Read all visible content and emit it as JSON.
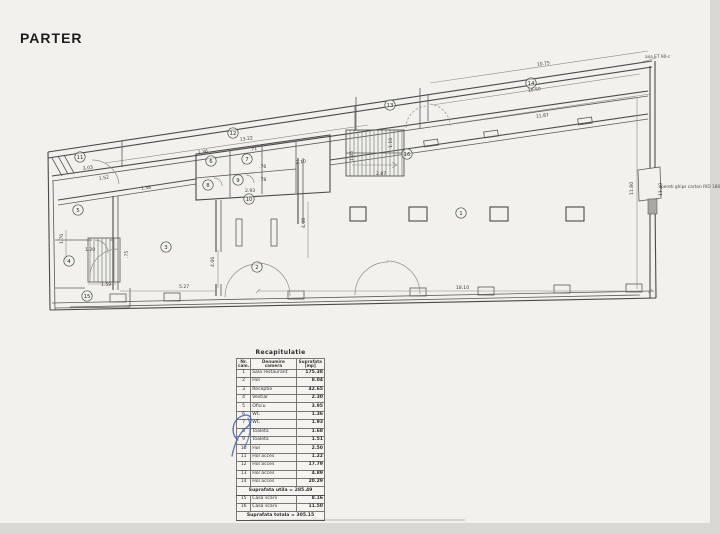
{
  "page": {
    "title": "PARTER"
  },
  "plan": {
    "dimensions": [
      {
        "t": "3.03",
        "x": 83,
        "y": 170,
        "r": -9
      },
      {
        "t": "1.52",
        "x": 99,
        "y": 180,
        "r": -9
      },
      {
        "t": "1.38",
        "x": 141,
        "y": 190,
        "r": -8
      },
      {
        "t": "13.22",
        "x": 240,
        "y": 141,
        "r": -8
      },
      {
        "t": "10.75",
        "x": 537,
        "y": 66,
        "r": -8
      },
      {
        "t": "10.50",
        "x": 528,
        "y": 92,
        "r": -8
      },
      {
        "t": "11.87",
        "x": 536,
        "y": 118,
        "r": -8
      },
      {
        "t": "1.36",
        "x": 198,
        "y": 154,
        "r": -8
      },
      {
        "t": ".71",
        "x": 250,
        "y": 151,
        "r": -8
      },
      {
        "t": ".76",
        "x": 259,
        "y": 168,
        "r": 0
      },
      {
        "t": ".78",
        "x": 259,
        "y": 181,
        "r": 0
      },
      {
        "t": "2.10",
        "x": 296,
        "y": 164,
        "r": -8
      },
      {
        "t": "2.93",
        "x": 245,
        "y": 192,
        "r": 0
      },
      {
        "t": "2.87",
        "x": 376,
        "y": 175,
        "r": 0
      },
      {
        "t": "1.16",
        "x": 392,
        "y": 148,
        "r": -90
      },
      {
        "t": "1.05",
        "x": 353,
        "y": 161,
        "r": -90
      },
      {
        "t": "1.70",
        "x": 63,
        "y": 244,
        "r": -90
      },
      {
        "t": "1.20",
        "x": 85,
        "y": 251,
        "r": 0
      },
      {
        "t": ".75",
        "x": 128,
        "y": 258,
        "r": -90
      },
      {
        "t": "1.59",
        "x": 101,
        "y": 286,
        "r": 0
      },
      {
        "t": "5.27",
        "x": 179,
        "y": 288,
        "r": 0
      },
      {
        "t": "18.10",
        "x": 456,
        "y": 289,
        "r": 0
      },
      {
        "t": "4.06",
        "x": 214,
        "y": 267,
        "r": -90
      },
      {
        "t": "4.08",
        "x": 305,
        "y": 228,
        "r": -90
      },
      {
        "t": "11.80",
        "x": 633,
        "y": 195,
        "r": -90
      },
      {
        "t": "11.40",
        "x": 662,
        "y": 196,
        "r": -90
      }
    ],
    "rooms": [
      {
        "n": "1",
        "x": 461,
        "y": 213
      },
      {
        "n": "2",
        "x": 257,
        "y": 267
      },
      {
        "n": "3",
        "x": 166,
        "y": 247
      },
      {
        "n": "4",
        "x": 69,
        "y": 261
      },
      {
        "n": "5",
        "x": 78,
        "y": 210
      },
      {
        "n": "6",
        "x": 211,
        "y": 161
      },
      {
        "n": "7",
        "x": 247,
        "y": 159
      },
      {
        "n": "8",
        "x": 208,
        "y": 185
      },
      {
        "n": "9",
        "x": 238,
        "y": 180
      },
      {
        "n": "10",
        "x": 249,
        "y": 199
      },
      {
        "n": "11",
        "x": 80,
        "y": 157
      },
      {
        "n": "12",
        "x": 233,
        "y": 133
      },
      {
        "n": "13",
        "x": 390,
        "y": 105
      },
      {
        "n": "14",
        "x": 531,
        "y": 83
      },
      {
        "n": "15",
        "x": 87,
        "y": 296
      },
      {
        "n": "16",
        "x": 407,
        "y": 154
      }
    ],
    "notes": [
      {
        "t": "axa ET 90-c",
        "x": 645,
        "y": 58
      },
      {
        "t": "pereti ghips carton RID 180",
        "x": 661,
        "y": 188
      }
    ]
  },
  "table": {
    "title": "Recapitulatie",
    "columns": [
      "Nr.\ncam.",
      "Denumire\ncamera",
      "Suprafata\n[mp]"
    ],
    "rows": [
      [
        "1",
        "Sala restaurant",
        "175.38"
      ],
      [
        "2",
        "Hol",
        "8.04"
      ],
      [
        "3",
        "Receptie",
        "42.65"
      ],
      [
        "4",
        "Vestiar",
        "2.30"
      ],
      [
        "5",
        "Oficiu",
        "3.95"
      ],
      [
        "6",
        "WC",
        "1.36"
      ],
      [
        "7",
        "WC",
        "1.93"
      ],
      [
        "8",
        "Toaleta",
        "1.68"
      ],
      [
        "9",
        "Toaleta",
        "1.51"
      ],
      [
        "10",
        "Hol",
        "2.50"
      ],
      [
        "11",
        "Hol acces",
        "1.22"
      ],
      [
        "12",
        "Hol acces",
        "17.79"
      ],
      [
        "13",
        "Hol acces",
        "4.89"
      ],
      [
        "14",
        "Hol acces",
        "20.29"
      ]
    ],
    "subtotal": "Suprafata utila = 285.49",
    "rows2": [
      [
        "15",
        "Casa scarii",
        "8.16"
      ],
      [
        "16",
        "Casa scarii",
        "11.50"
      ]
    ],
    "total": "Suprafata totala = 305.15"
  }
}
